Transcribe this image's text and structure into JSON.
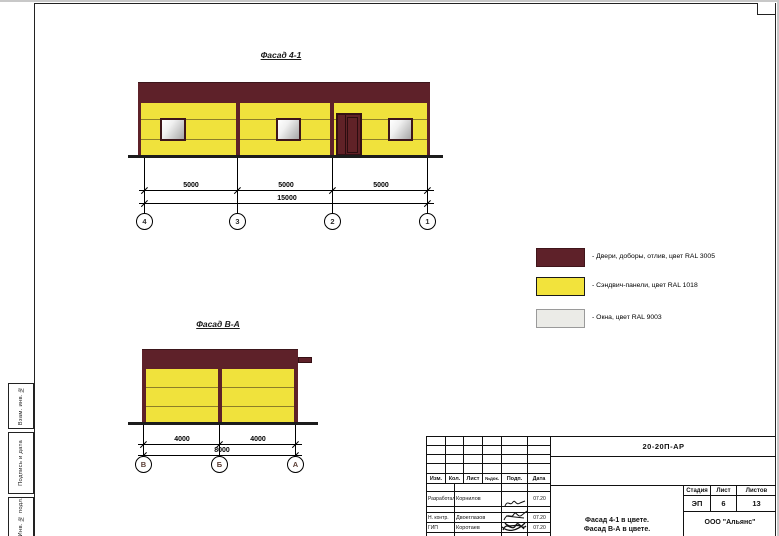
{
  "colors": {
    "ral3005_doors": "#5e2129",
    "ral1018_panels": "#f0e23c",
    "ral9003_windows": "#ebebe7"
  },
  "facade_top": {
    "title": "Фасад 4-1",
    "dim_segments": [
      "5000",
      "5000",
      "5000"
    ],
    "dim_total": "15000",
    "axis_bubbles": [
      "4",
      "3",
      "2",
      "1"
    ]
  },
  "facade_side": {
    "title": "Фасад В-А",
    "dim_segments": [
      "4000",
      "4000"
    ],
    "dim_total": "8000",
    "axis_bubbles": [
      "В",
      "Б",
      "А"
    ]
  },
  "legend": {
    "items": [
      {
        "swatch_color": "#5e2129",
        "label": "- Двери, доборы, отлив, цвет RAL 3005"
      },
      {
        "swatch_color": "#f2e33c",
        "label": "- Сэндвич-панели, цвет RAL 1018"
      },
      {
        "swatch_color": "#ebebe7",
        "label": "- Окна, цвет RAL 9003"
      }
    ]
  },
  "side_strip": {
    "labels": [
      "Взам. инв. №",
      "Подпись и дата",
      "Инв. № подл."
    ]
  },
  "title_block": {
    "document_code": "20-20П-АР",
    "revision_headers": [
      "Изм.",
      "Кол.",
      "Лист",
      "№док.",
      "Подп.",
      "Дата"
    ],
    "signature_rows": [
      {
        "role": "Разработал",
        "name": "Корнилов",
        "date": "07.20"
      },
      {
        "role": "Н. контр.",
        "name": "Двоеглазов",
        "date": "07.20"
      },
      {
        "role": "ГИП",
        "name": "Коротаев",
        "date": "07.20"
      }
    ],
    "stage_header": "Стадия",
    "sheet_header": "Лист",
    "sheets_header": "Листов",
    "stage": "ЭП",
    "sheet_number": "6",
    "sheet_count": "13",
    "subject_line1": "Фасад 4-1 в цвете.",
    "subject_line2": "Фасад В-А в цвете.",
    "company": "ООО \"Альянс\""
  }
}
